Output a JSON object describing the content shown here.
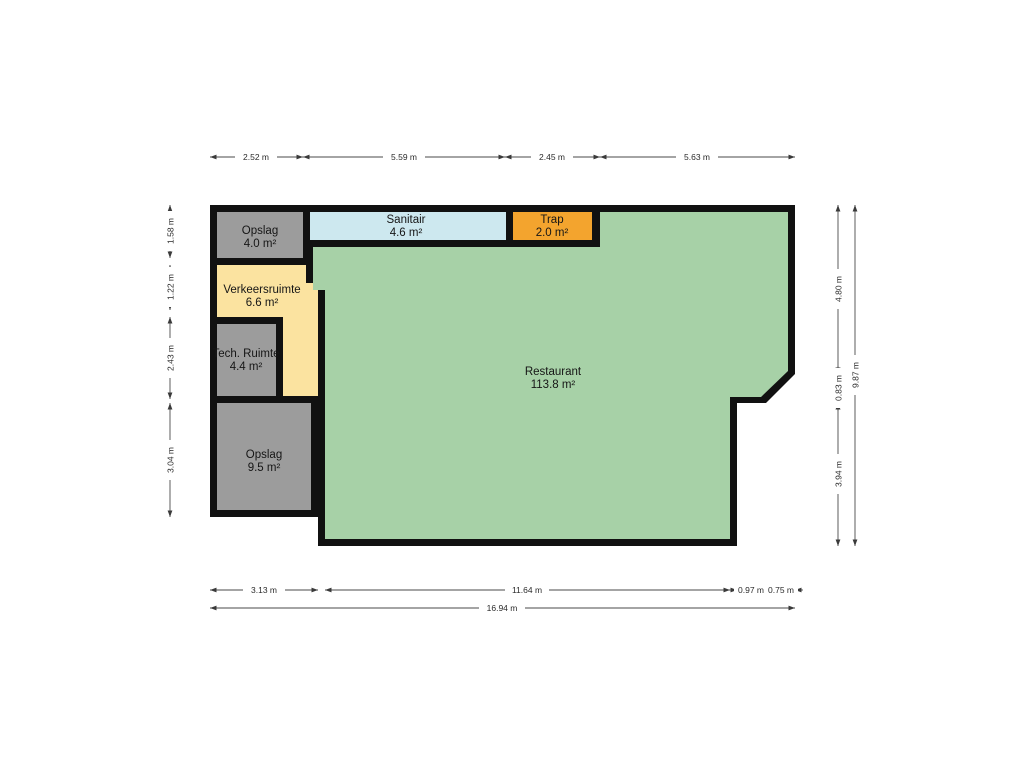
{
  "floorplan": {
    "wall_color": "#111111",
    "rooms": {
      "opslag_small": {
        "name": "Opslag",
        "area": "4.0 m²",
        "color": "#9c9c9c"
      },
      "sanitair": {
        "name": "Sanitair",
        "area": "4.6 m²",
        "color": "#cde8ef"
      },
      "trap": {
        "name": "Trap",
        "area": "2.0 m²",
        "color": "#f3a42e"
      },
      "verkeersruimte": {
        "name": "Verkeersruimte",
        "area": "6.6 m²",
        "color": "#fbe3a0"
      },
      "tech_ruimte": {
        "name": "Tech. Ruimte",
        "area": "4.4 m²",
        "color": "#9c9c9c"
      },
      "opslag_large": {
        "name": "Opslag",
        "area": "9.5 m²",
        "color": "#9c9c9c"
      },
      "restaurant": {
        "name": "Restaurant",
        "area": "113.8 m²",
        "color": "#a7d1a7"
      }
    },
    "dimensions": {
      "top": [
        "2.52 m",
        "5.59 m",
        "2.45 m",
        "5.63 m"
      ],
      "bottom": [
        "3.13 m",
        "11.64 m",
        "0.97 m",
        "0.75 m"
      ],
      "bottom_total": "16.94 m",
      "left": [
        "1.58 m",
        "1.22 m",
        "2.43 m",
        "3.04 m"
      ],
      "right": [
        "4.80 m",
        "0.83 m",
        "3.94 m"
      ],
      "right_total": "9.87 m"
    }
  }
}
